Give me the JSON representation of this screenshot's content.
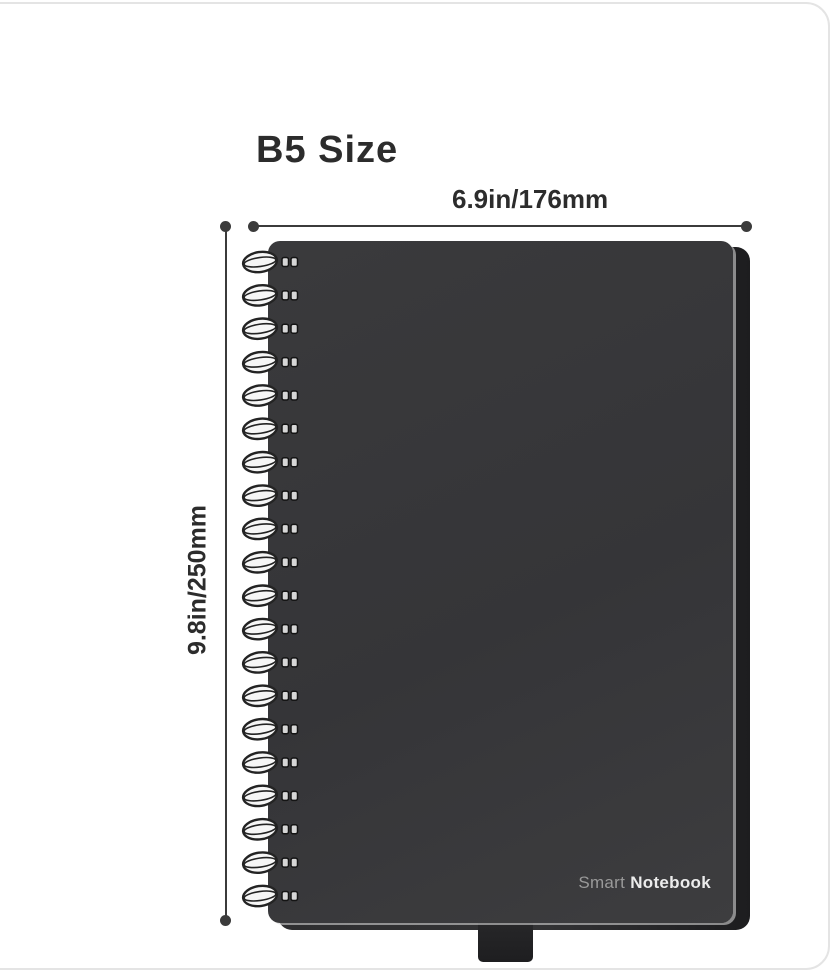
{
  "page": {
    "title": "B5 Size",
    "dimensions": {
      "width_label": "6.9in/176mm",
      "height_label": "9.8in/250mm"
    },
    "brand": {
      "light": "Smart",
      "bold": "Notebook"
    },
    "notebook": {
      "spiral_loop_count": 20
    },
    "colors": {
      "cover": "#353538",
      "cover_back": "#1d1d1f",
      "dimension_line": "#3b3b3b",
      "text_dark": "#2c2c2c",
      "brand_light": "#9a9a9a",
      "brand_bold": "#ececec",
      "card_border": "#e4e4e4",
      "background": "#ffffff",
      "spiral_wire_fill": "#f6f6f6",
      "spiral_wire_stroke": "#232323",
      "spiral_hole_fill": "#d6d6d6",
      "spiral_hole_stroke": "#141414"
    }
  }
}
